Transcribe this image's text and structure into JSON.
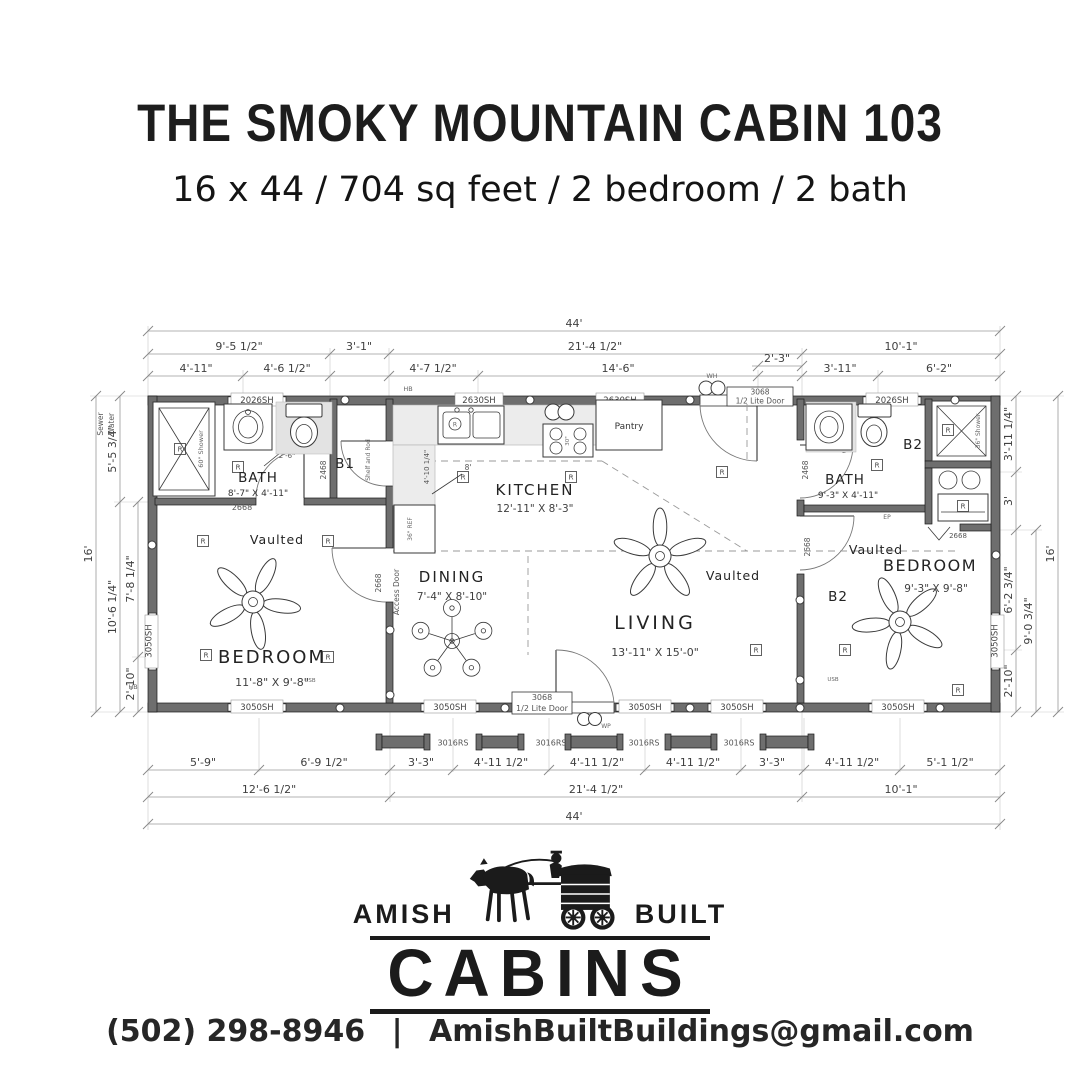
{
  "header": {
    "title": "THE SMOKY MOUNTAIN CABIN 103",
    "subtitle": "16 x 44 / 704 sq feet / 2 bedroom / 2 bath"
  },
  "plan": {
    "top": {
      "overall": "44'",
      "r2": [
        "9'-5 1/2\"",
        "3'-1\"",
        "21'-4 1/2\"",
        "10'-1\""
      ],
      "r3": [
        "4'-11\"",
        "4'-6 1/2\"",
        "4'-7 1/2\"",
        "14'-6\"",
        "3'-11\"",
        "6'-2\""
      ],
      "inset": "2'-3\""
    },
    "bottom": {
      "r1": [
        "5'-9\"",
        "6'-9 1/2\"",
        "3'-3\"",
        "4'-11 1/2\"",
        "4'-11 1/2\"",
        "4'-11 1/2\"",
        "3'-3\"",
        "4'-11 1/2\"",
        "5'-1 1/2\""
      ],
      "r2": [
        "12'-6 1/2\"",
        "21'-4 1/2\"",
        "10'-1\""
      ],
      "overall": "44'"
    },
    "left": {
      "overall": "16'",
      "segs": [
        "5'-5 3/4\"",
        "10'-6 1/4\"",
        "7'-8 1/4\"",
        "2'-10\""
      ],
      "sewer": "Sewer",
      "water": "Water"
    },
    "right": {
      "overall": "16'",
      "segs": [
        "3'-11 1/4\"",
        "3'",
        "6'-2 3/4\"",
        "2'-10\""
      ],
      "sub": "9'-0 3/4\""
    },
    "rooms": {
      "bath1": "BATH",
      "bath1_size": "8'-7\" X 4'-11\"",
      "b1": "B1",
      "bedroom1": "BEDROOM",
      "bedroom1_size": "11'-8\" X 9'-8\"",
      "kitchen": "KITCHEN",
      "kitchen_size": "12'-11\" X 8'-3\"",
      "dining": "DINING",
      "dining_size": "7'-4\" X 8'-10\"",
      "living": "LIVING",
      "living_size": "13'-11\" X 15'-0\"",
      "bath2": "BATH",
      "bath2_size": "9'-3\" X 4'-11\"",
      "b2": "B2",
      "bedroom2": "BEDROOM",
      "bedroom2_size": "9'-3\" X 9'-8\"",
      "pantry": "Pantry",
      "vaulted": "Vaulted"
    },
    "openings": {
      "w2026": "2026SH",
      "w2630": "2630SH",
      "w3050": "3050SH",
      "rail": "3016RS",
      "d3068": "3068",
      "half_lite": "1/2 Lite Door",
      "d2468": "2468",
      "d2668": "2668",
      "access": "Access Door",
      "swing26": "2'-6\"",
      "swing2": "2'"
    },
    "fixtures": {
      "shower60": "60\" Shower",
      "shower36": "36\" Shower",
      "fridge": "36\" REF",
      "range30": "30\"",
      "shelf": "Shelf and Rod",
      "wh": "WH",
      "wp": "WP",
      "ep": "EP",
      "usb": "USB",
      "hb": "HB",
      "light": "R",
      "ceil8": "8'",
      "kdim": "4'-10 1/4\""
    }
  },
  "logo": {
    "left": "AMISH",
    "right": "BUILT",
    "main": "CABINS"
  },
  "footer": {
    "phone": "(502) 298-8946",
    "sep": "|",
    "email": "AmishBuiltBuildings@gmail.com"
  }
}
